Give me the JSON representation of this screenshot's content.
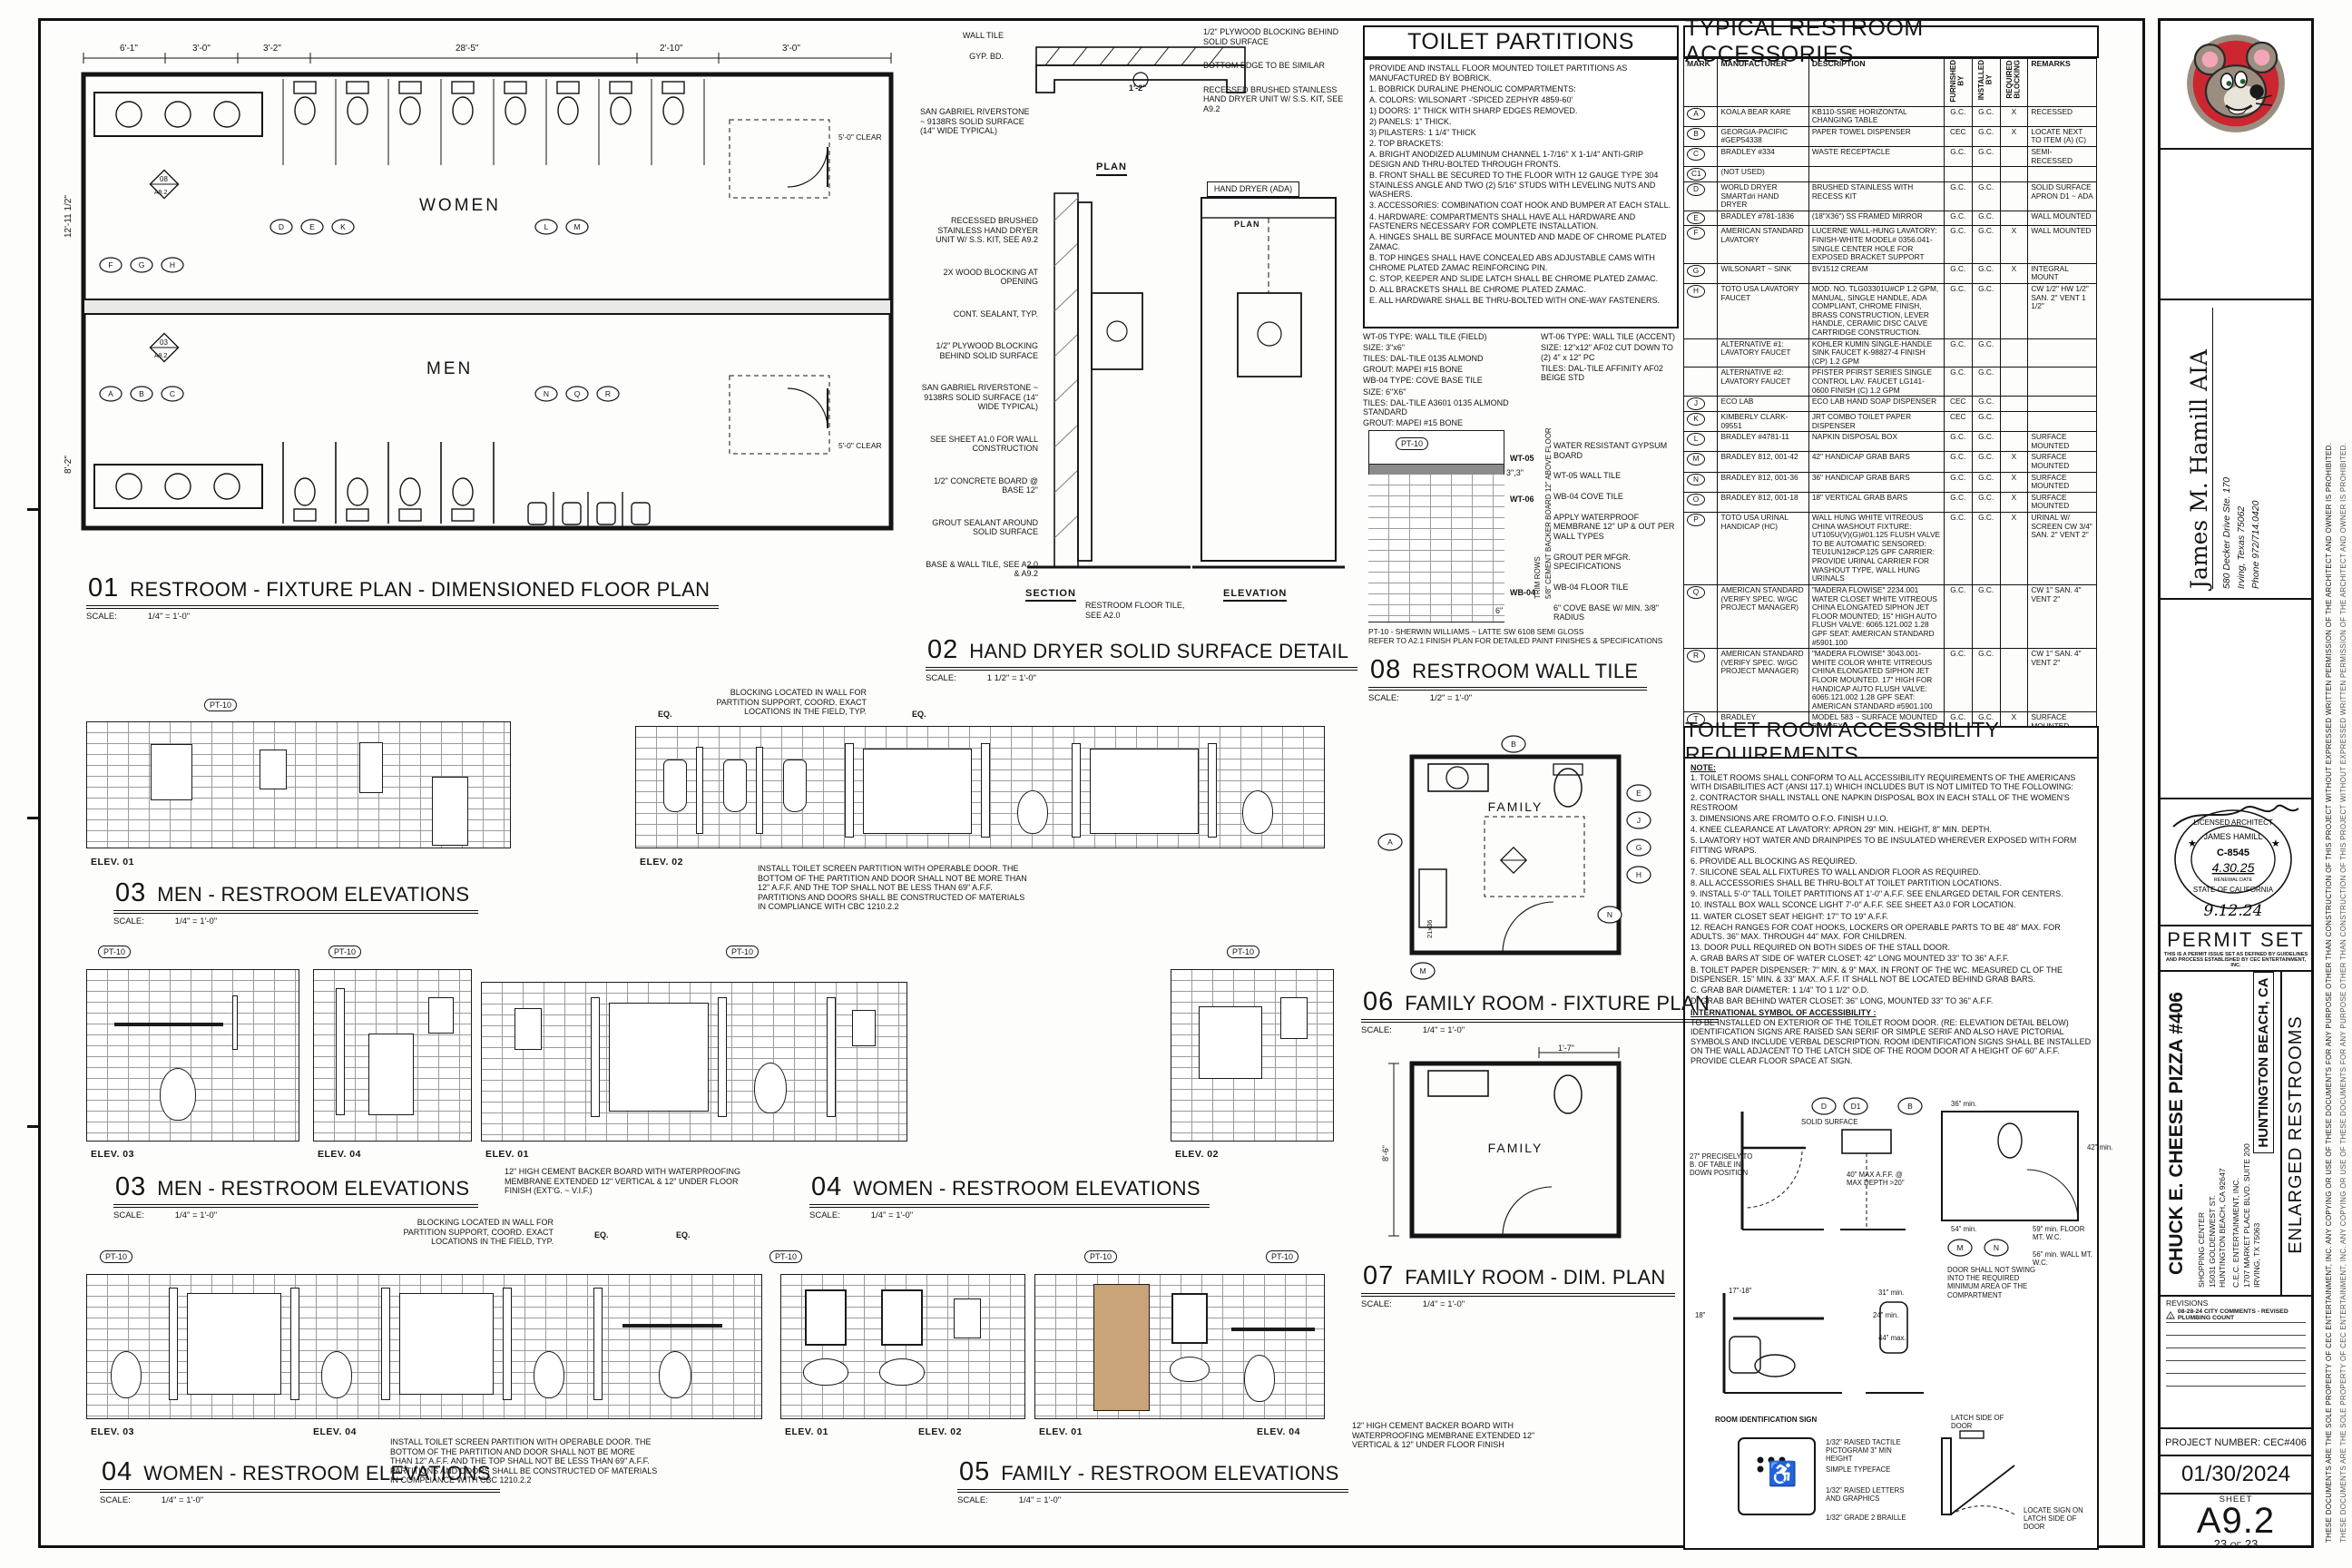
{
  "colors": {
    "logo_red": "#cc2630",
    "logo_taupe": "#9b8d80",
    "door_tan": "#c9a478",
    "accent_band": "#8b8b8b"
  },
  "labels": {
    "scale": "SCALE:",
    "plan": "PLAN",
    "section": "SECTION",
    "elevation": "ELEVATION",
    "women": "WOMEN",
    "men": "MEN",
    "family": "FAMILY",
    "eq": "EQ.",
    "pt10": "PT-10",
    "trash": "TRASH",
    "elev01": "ELEV. 01",
    "elev02": "ELEV. 02",
    "elev03": "ELEV. 03",
    "elev04": "ELEV. 04",
    "sheetref": "A7.5",
    "t1": "01",
    "t2": "02",
    "t3": "03",
    "t4": "04"
  },
  "panels": {
    "d01": {
      "num": "01",
      "title": "RESTROOM - FIXTURE PLAN - DIMENSIONED FLOOR PLAN",
      "scale": "1/4\" = 1'-0\""
    },
    "d02": {
      "num": "02",
      "title": "HAND DRYER SOLID SURFACE DETAIL",
      "scale": "1 1/2\" = 1'-0\""
    },
    "d03": {
      "num": "03",
      "title": "MEN - RESTROOM ELEVATIONS",
      "scale": "1/4\" = 1'-0\""
    },
    "d04": {
      "num": "04",
      "title": "WOMEN - RESTROOM ELEVATIONS",
      "scale": "1/4\" = 1'-0\""
    },
    "d05": {
      "num": "05",
      "title": "FAMILY - RESTROOM ELEVATIONS",
      "scale": "1/4\" = 1'-0\""
    },
    "d06": {
      "num": "06",
      "title": "FAMILY ROOM - FIXTURE PLAN",
      "scale": "1/4\" = 1'-0\""
    },
    "d07": {
      "num": "07",
      "title": "FAMILY ROOM - DIM. PLAN",
      "scale": "1/4\" = 1'-0\""
    },
    "d08": {
      "num": "08",
      "title": "RESTROOM WALL TILE",
      "scale": "1/2\" = 1'-0\""
    }
  },
  "partitions": {
    "title": "TOILET PARTITIONS",
    "lines": [
      "PROVIDE AND INSTALL FLOOR MOUNTED TOILET PARTITIONS AS MANUFACTURED BY BOBRICK.",
      "1. BOBRICK DURALINE PHENOLIC COMPARTMENTS:",
      "A. COLORS:  WILSONART -'SPICED ZEPHYR 4859-60'",
      "1) DOORS: 1\" THICK WITH SHARP EDGES REMOVED.",
      "2) PANELS:  1\" THICK.",
      "3)  PILASTERS:  1 1/4\" THICK",
      "2. TOP BRACKETS:",
      "A. BRIGHT ANODIZED ALUMINUM CHANNEL 1-7/16\" X 1-1/4\" ANTI-GRIP DESIGN AND THRU-BOLTED THROUGH FRONTS.",
      "B. FRONT SHALL BE SECURED TO THE FLOOR WITH 12 GAUGE TYPE 304 STAINLESS ANGLE AND TWO (2) 5/16\" STUDS WITH LEVELING NUTS AND WASHERS.",
      "3. ACCESSORIES:  COMBINATION COAT HOOK AND BUMPER AT EACH STALL.",
      "4. HARDWARE: COMPARTMENTS SHALL HAVE ALL HARDWARE AND FASTENERS NECESSARY FOR COMPLETE INSTALLATION.",
      "A. HINGES SHALL BE SURFACE MOUNTED AND MADE OF CHROME PLATED ZAMAC.",
      "B. TOP HINGES SHALL HAVE CONCEALED ABS ADJUSTABLE CAMS WITH CHROME PLATED ZAMAC REINFORCING PIN.",
      "C. STOP, KEEPER AND SLIDE LATCH SHALL BE CHROME PLATED ZAMAC.",
      "D. ALL BRACKETS SHALL BE CHROME PLATED ZAMAC.",
      "E.  ALL HARDWARE SHALL BE THRU-BOLTED WITH ONE-WAY FASTENERS."
    ]
  },
  "tile": {
    "wt05": [
      "WT-05 TYPE: WALL TILE (FIELD)",
      "SIZE:  3\"x6\"",
      "TILES: DAL-TILE 0135 ALMOND",
      "GROUT:      MAPEI #15 BONE",
      "WB-04 TYPE: COVE BASE TILE",
      "SIZE:  6\"X6\"",
      "TILES: DAL-TILE A3601 0135 ALMOND STANDARD",
      "GROUT:      MAPEI #15 BONE"
    ],
    "wt06": [
      "WT-06 TYPE: WALL TILE (ACCENT)",
      "SIZE:  12\"x12\" AF02 CUT DOWN TO (2) 4\" x 12\" PC",
      "TILES: DAL-TILE  AFFINITY AF02 BEIGE STD"
    ],
    "tag05": "WT-05",
    "tag06": "WT-06",
    "tag04": "WB-04",
    "callouts_right": [
      "WATER RESISTANT GYPSUM BOARD",
      "WT-05 WALL TILE",
      "WB-04 COVE TILE",
      "APPLY WATERPROOF MEMBRANE 12\" UP & OUT PER WALL TYPES",
      "GROUT PER MFGR. SPECIFICATIONS",
      "WB-04 FLOOR TILE",
      "6\" COVE BASE W/ MIN. 3/8\" RADIUS"
    ],
    "vert1": "5/8\" CEMENT BACKER BOARD 12\" ABOVE FLOOR",
    "vert2": "TRIM ROWS",
    "dim33": "3\",3\"",
    "dim6": "6\"",
    "note1": "PT-10 - SHERWIN WILLIAMS ~ LATTE SW 6108 SEMI GLOSS",
    "note2": "REFER TO A2.1 FINISH PLAN FOR DETAILED PAINT FINISHES & SPECIFICATIONS"
  },
  "accessories": {
    "title": "TYPICAL RESTROOM ACCESSORIES",
    "h_mark": "MARK",
    "h_mfr": "MANUFACTURER",
    "h_desc": "DESCRIPTION",
    "h_furn": "FURNISHED\nBY",
    "h_inst": "INSTALLED\nBY",
    "h_blk": "REQUIRED\nBLOCKING",
    "h_rem": "REMARKS",
    "rows": [
      {
        "m": "A",
        "mfr": "KOALA BEAR KARE",
        "d": "KB110-SSRE HORIZONTAL CHANGING TABLE",
        "f": "G.C.",
        "i": "G.C.",
        "b": "X",
        "r": "RECESSED"
      },
      {
        "m": "B",
        "mfr": "GEORGIA-PACIFIC #GEP54338",
        "d": "PAPER TOWEL DISPENSER",
        "f": "CEC",
        "i": "G.C.",
        "b": "X",
        "r": "LOCATE NEXT TO ITEM (A) (C)"
      },
      {
        "m": "C",
        "mfr": "BRADLEY #334",
        "d": "WASTE RECEPTACLE",
        "f": "G.C.",
        "i": "G.C.",
        "b": "",
        "r": "SEMI-RECESSED"
      },
      {
        "m": "C1",
        "mfr": "(NOT USED)",
        "d": "",
        "f": "",
        "i": "",
        "b": "",
        "r": ""
      },
      {
        "m": "D",
        "mfr": "WORLD DRYER SMARTdri HAND DRYER",
        "d": "BRUSHED STAINLESS WITH RECESS KIT",
        "f": "G.C.",
        "i": "G.C.",
        "b": "",
        "r": "SOLID SURFACE APRON D1 ~ ADA"
      },
      {
        "m": "E",
        "mfr": "BRADLEY #781-1836",
        "d": "(18\"X36\") SS FRAMED MIRROR",
        "f": "G.C.",
        "i": "G.C.",
        "b": "",
        "r": "WALL MOUNTED"
      },
      {
        "m": "F",
        "mfr": "AMERICAN STANDARD LAVATORY",
        "d": "LUCERNE WALL-HUNG LAVATORY: FINISH-WHITE MODEL# 0356.041-SINGLE CENTER HOLE FOR EXPOSED BRACKET SUPPORT",
        "f": "G.C.",
        "i": "G.C.",
        "b": "X",
        "r": "WALL MOUNTED"
      },
      {
        "m": "G",
        "mfr": "WILSONART ~ SINK",
        "d": "BV1512 CREAM",
        "f": "G.C.",
        "i": "G.C.",
        "b": "X",
        "r": "INTEGRAL MOUNT"
      },
      {
        "m": "H",
        "mfr": "TOTO USA LAVATORY FAUCET",
        "d": "MOD. NO. TLG03301U#CP 1.2 GPM, MANUAL, SINGLE HANDLE, ADA COMPLIANT, CHROME FINISH, BRASS CONSTRUCTION, LEVER HANDLE, CERAMIC DISC CALVE CARTRIDGE CONSTRUCTION.",
        "f": "G.C.",
        "i": "G.C.",
        "b": "",
        "r": "CW 1/2\"  HW 1/2\"  SAN. 2\"  VENT 1 1/2\""
      },
      {
        "m": "",
        "mfr": "ALTERNATIVE #1: LAVATORY FAUCET",
        "d": "KOHLER KUMIN SINGLE-HANDLE SINK FAUCET K-98827-4 FINISH (CP)  1.2 GPM",
        "f": "G.C.",
        "i": "G.C.",
        "b": "",
        "r": ""
      },
      {
        "m": "",
        "mfr": "ALTERNATIVE #2: LAVATORY FAUCET",
        "d": "PFISTER PFIRST SERIES SINGLE CONTROL LAV. FAUCET LG141-0600 FINISH (C)  1.2 GPM",
        "f": "G.C.",
        "i": "G.C.",
        "b": "",
        "r": ""
      },
      {
        "m": "J",
        "mfr": "ECO LAB",
        "d": "ECO LAB HAND SOAP DISPENSER",
        "f": "CEC",
        "i": "G.C.",
        "b": "",
        "r": ""
      },
      {
        "m": "K",
        "mfr": "KIMBERLY CLARK-09551",
        "d": "JRT COMBO TOILET PAPER DISPENSER",
        "f": "CEC",
        "i": "G.C.",
        "b": "",
        "r": ""
      },
      {
        "m": "L",
        "mfr": "BRADLEY #4781-11",
        "d": "NAPKIN DISPOSAL BOX",
        "f": "G.C.",
        "i": "G.C.",
        "b": "",
        "r": "SURFACE MOUNTED"
      },
      {
        "m": "M",
        "mfr": "BRADLEY 812, 001-42",
        "d": "42\" HANDICAP GRAB BARS",
        "f": "G.C.",
        "i": "G.C.",
        "b": "X",
        "r": "SURFACE MOUNTED"
      },
      {
        "m": "N",
        "mfr": "BRADLEY 812, 001-36",
        "d": "36\" HANDICAP GRAB BARS",
        "f": "G.C.",
        "i": "G.C.",
        "b": "X",
        "r": "SURFACE MOUNTED"
      },
      {
        "m": "O",
        "mfr": "BRADLEY 812, 001-18",
        "d": "18\" VERTICAL GRAB BARS",
        "f": "G.C.",
        "i": "G.C.",
        "b": "X",
        "r": "SURFACE MOUNTED"
      },
      {
        "m": "P",
        "mfr": "TOTO USA URINAL HANDICAP (HC)",
        "d": "WALL HUNG WHITE VITREOUS CHINA WASHOUT FIXTURE: UT105U(V)(G)#01.125  FLUSH VALVE TO BE AUTOMATIC SENSORED: TEU1UN12#CP.125 GPF  CARRIER: PROVIDE URINAL CARRIER FOR WASHOUT TYPE, WALL HUNG URINALS",
        "f": "G.C.",
        "i": "G.C.",
        "b": "X",
        "r": "URINAL W/ SCREEN   CW 3/4\"  SAN. 2\"  VENT 2\""
      },
      {
        "m": "Q",
        "mfr": "AMERICAN STANDARD (VERIFY SPEC. W/GC PROJECT MANAGER)",
        "d": "\"MADERA FLOWISE\" 2234.001 WATER CLOSET WHITE VITREOUS CHINA ELONGATED SIPHON JET FLOOR MOUNTED; 15\" HIGH   AUTO FLUSH VALVE: 6065.121.002  1.28 GPF   SEAT: AMERICAN STANDARD #5901.100",
        "f": "G.C.",
        "i": "G.C.",
        "b": "",
        "r": "CW 1\"  SAN. 4\"  VENT 2\""
      },
      {
        "m": "R",
        "mfr": "AMERICAN STANDARD (VERIFY SPEC. W/GC PROJECT MANAGER)",
        "d": "\"MADERA FLOWISE\" 3043.001-WHITE COLOR WHITE VITREOUS CHINA ELONGATED SIPHON JET FLOOR MOUNTED. 17\" HIGH FOR HANDICAP   AUTO FLUSH VALVE: 6065.121.002  1.28 GPF   SEAT: AMERICAN STANDARD #5901.100",
        "f": "G.C.",
        "i": "G.C.",
        "b": "",
        "r": "CW 1\"  SAN. 4\"  VENT 2\""
      },
      {
        "m": "T",
        "mfr": "BRADLEY",
        "d": "MODEL 583 ~ SURFACE MOUNTED BRADEX",
        "f": "G.C.",
        "i": "G.C.",
        "b": "X",
        "r": "SURFACE MOUNTED"
      },
      {
        "m": "SS-04",
        "mfr": "WILSONART COUNTER",
        "d": "SAN GABRIEL RIVERSTONE 9138RS SOLID SURFACE",
        "f": "G.C.",
        "i": "G.C.",
        "b": "",
        "r": ""
      }
    ]
  },
  "access": {
    "title": "TOILET ROOM ACCESSIBILITY REQUIREMENTS",
    "note_label": "NOTE:",
    "notes": [
      "1. TOILET ROOMS SHALL CONFORM TO ALL ACCESSIBILITY REQUIREMENTS OF THE AMERICANS WITH DISABILITIES ACT (ANSI 117.1) WHICH  INCLUDES BUT IS NOT LIMITED TO THE FOLLOWING:",
      "2. CONTRACTOR SHALL INSTALL ONE NAPKIN DISPOSAL BOX IN EACH STALL OF THE WOMEN'S RESTROOM",
      "3. DIMENSIONS ARE FROM/TO O.F.O. FINISH U.I.O.",
      "4. KNEE CLEARANCE AT LAVATORY: APRON 29\" MIN. HEIGHT, 8\" MIN. DEPTH.",
      "5. LAVATORY HOT WATER AND DRAINPIPES TO BE INSULATED WHEREVER EXPOSED WITH FORM FITTING WRAPS.",
      "6. PROVIDE ALL BLOCKING AS REQUIRED.",
      "7. SILICONE SEAL ALL FIXTURES TO WALL AND/OR FLOOR AS REQUIRED.",
      "8. ALL ACCESSORIES SHALL BE THRU-BOLT AT TOILET PARTITION LOCATIONS.",
      "9. INSTALL 5'-0\" TALL TOILET PARTITIONS AT 1'-0\" A.F.F. SEE ENLARGED DETAIL FOR CENTERS.",
      "10. INSTALL BOX WALL SCONCE LIGHT 7'-0\" A.F.F. SEE SHEET A3.0 FOR LOCATION.",
      "11. WATER CLOSET SEAT HEIGHT: 17\" TO 19\" A.F.F.",
      "12. REACH RANGES FOR COAT HOOKS, LOCKERS OR OPERABLE PARTS TO BE 48\" MAX. FOR ADULTS. 36\" MAX. THROUGH 44\" MAX. FOR CHILDREN.",
      "13. DOOR PULL REQUIRED ON BOTH SIDES OF THE STALL DOOR.",
      "A. GRAB BARS AT SIDE OF WATER CLOSET: 42\" LONG MOUNTED 33\" TO 36\" A.F.F.",
      "B. TOILET PAPER DISPENSER: 7\" MIN. & 9\" MAX. IN FRONT OF THE WC. MEASURED CL OF THE DISPENSER. 15\" MIN. & 33\" MAX. A.F.F. IT SHALL NOT BE LOCATED BEHIND GRAB BARS.",
      "C. GRAB BAR DIAMETER: 1 1/4\" TO 1 1/2\" O.D.",
      "D. GRAB BAR BEHIND WATER CLOSET: 36\" LONG, MOUNTED 33\" TO 36\" A.F.F."
    ],
    "isa_heading": "INTERNATIONAL SYMBOL OF ACCESSIBILITY :",
    "isa_text": "TO BE INSTALLED ON EXTERIOR OF THE TOILET ROOM DOOR. (RE: ELEVATION DETAIL BELOW) IDENTIFICATION SIGNS ARE RAISED SAN SERIF OR SIMPLE SERIF AND ALSO HAVE PICTORIAL SYMBOLS AND INCLUDE VERBAL DESCRIPTION. ROOM IDENTIFICATION SIGNS SHALL BE INSTALLED ON THE WALL ADJACENT TO THE LATCH SIDE OF THE ROOM DOOR AT A HEIGHT OF 60\" A.F.F. PROVIDE CLEAR FLOOR SPACE AT SIGN.",
    "diagram": {
      "d27": "27\" PRECISELY TO B. OF TABLE IN DOWN POSITION",
      "solid_surface": "SOLID SURFACE",
      "d40": "40\" MAX A.F.F. @ MAX DEPTH >20\"",
      "d31": "31\" min.",
      "d44": "44\" max.",
      "d36": "36\" min.",
      "d42": "42\" min.",
      "d54": "54\" min.",
      "d24": "24\" min.",
      "d18": "18\"",
      "d1718": "17\"-18\"",
      "d79": "7\"-9\"",
      "d6": "6\" max.",
      "d59": "59\" min. FLOOR MT. W.C.",
      "d56": "56\" min. WALL MT. W.C.",
      "door_note": "DOOR SHALL NOT SWING INTO THE REQUIRED MINIMUM AREA OF THE COMPARTMENT",
      "sign_title": "ROOM IDENTIFICATION SIGN",
      "sign1": "1/32\" RAISED TACTILE PICTOGRAM 3\" MIN HEIGHT",
      "sign2": "SIMPLE TYPEFACE",
      "sign3": "1/32\" RAISED LETTERS AND GRAPHICS",
      "sign4": "1/32\" GRADE 2  BRAILLE",
      "latch1": "LATCH SIDE OF DOOR",
      "latch2": "LOCATE SIGN ON LATCH SIDE OF DOOR",
      "b1": "D",
      "b2": "D1",
      "b3": "B",
      "b4": "J",
      "b5": "M",
      "b6": "N",
      "b7": "R"
    }
  },
  "detail02": {
    "plan_left": [
      "WALL TILE",
      "GYP. BD."
    ],
    "plan_right": [
      "1/2\" PLYWOOD BLOCKING BEHIND SOLID SURFACE",
      "BOTTOM EDGE TO BE SIMILAR",
      "RECESSED BRUSHED STAINLESS HAND DRYER UNIT W/ S.S. KIT, SEE A9.2"
    ],
    "plan_dim": "1'-2\"",
    "sg": "SAN GABRIEL RIVERSTONE ~ 9138RS SOLID SURFACE (14\" WIDE TYPICAL)",
    "section_callouts": [
      "RECESSED BRUSHED STAINLESS HAND DRYER UNIT W/ S.S. KIT, SEE A9.2",
      "2X WOOD BLOCKING AT OPENING",
      "CONT. SEALANT, TYP.",
      "1/2\" PLYWOOD BLOCKING BEHIND SOLID SURFACE",
      "SAN GABRIEL RIVERSTONE ~ 9138RS SOLID SURFACE (14\" WIDE TYPICAL)",
      "SEE  SHEET A1.0 FOR WALL CONSTRUCTION",
      "1/2\" CONCRETE BOARD @ BASE 12\"",
      "GROUT SEALANT AROUND SOLID SURFACE",
      "BASE & WALL TILE, SEE A2.0 & A9.2"
    ],
    "hand_dryer_ada": "HAND DRYER (ADA)",
    "floor_tile": "RESTROOM FLOOR TILE, SEE A2.0"
  },
  "plan01": {
    "women": "WOMEN",
    "men": "MEN",
    "dims": [
      "6'-1\"",
      "3'-0\"",
      "3'-2\"",
      "28'-5\"",
      "2'-10\"",
      "3'-0\"",
      "12'-11 1/2\"",
      "8'-2\"",
      "2'-8\"",
      "3 5/8\"",
      "2'-2\"",
      "5'-0\" CLEAR"
    ],
    "clear": "CLEAR",
    "bubbles": [
      "A",
      "B",
      "C",
      "D",
      "E",
      "F",
      "G",
      "H",
      "K",
      "L",
      "M",
      "N",
      "Q",
      "R"
    ],
    "dia_top1": "08",
    "dia_top2": "03",
    "dia_sheet": "A9.2"
  },
  "elevnotes": {
    "screen": "INSTALL TOILET SCREEN PARTITION WITH OPERABLE DOOR. THE BOTTOM OF THE PARTITION AND DOOR SHALL NOT BE MORE THAN 12\" A.F.F. AND THE TOP SHALL NOT BE LESS THAN 69\" A.F.F. PARTITIONS AND DOORS SHALL BE CONSTRUCTED OF MATERIALS IN COMPLIANCE WITH CBC 1210.2.2",
    "blocking": "BLOCKING LOCATED IN WALL FOR PARTITION SUPPORT, COORD. EXACT LOCATIONS IN THE FIELD, TYP.",
    "backer1": "12\" HIGH CEMENT BACKER BOARD WITH WATERPROOFING MEMBRANE EXTENDED 12\" VERTICAL & 12\" UNDER FLOOR FINISH (EXT'G. ~ V.I.F.)",
    "backer2": "12\" HIGH CEMENT BACKER BOARD WITH WATERPROOFING MEMBRANE EXTENDED 12\" VERTICAL & 12\" UNDER FLOOR FINISH"
  },
  "family": {
    "label": "FAMILY",
    "dim1": "8'-6\"",
    "dim2": "1'-7\"",
    "dim3": "5'-0\"",
    "table": "21x36",
    "bubbles": [
      "A",
      "B",
      "E",
      "J",
      "G",
      "H",
      "N",
      "M",
      "L",
      "K"
    ]
  },
  "titleblock": {
    "architect": {
      "name": "James M. Hamill AIA",
      "addr1": "580 Decker Drive Ste. 170",
      "addr2": "Irving, Texas  75062",
      "addr3": "Phone  972/714.0420"
    },
    "stamp": {
      "arc": "LICENSED ARCHITECT",
      "name": "JAMES HAMILL",
      "lic": "C-8545",
      "renewal": "4.30.25",
      "renewal_lbl": "RENEWAL DATE",
      "state": "STATE OF CALIFORNIA",
      "signed": "9.12.24"
    },
    "permit": {
      "title": "PERMIT SET",
      "sub1": "THIS IS A PERMIT ISSUE SET AS DEFINED BY GUIDELINES",
      "sub2": "AND  PROCESS  ESTABLISHED  BY  CEC   ENTERTAINMENT, INC."
    },
    "project": {
      "name": "CHUCK E. CHEESE PIZZA  #406",
      "center": "SHOPPING CENTER",
      "addr1": "15031 GOLDENWEST ST.",
      "addr2": "HUNTINGTON BEACH, CA 92647",
      "cec1": "C.E.C. ENTERTAINMENT, INC.",
      "cec2": "1707 MARKET PLACE BLVD. SUITE 200",
      "cec3": "IRVING, TX 75063",
      "city": "HUNTINGTON BEACH, CA",
      "sheet_name": "ENLARGED RESTROOMS"
    },
    "revisions": {
      "title": "REVISIONS",
      "r1_num": "1",
      "r1": "08-28-24 CITY COMMENTS - REVISED PLUMBING COUNT"
    },
    "proj_num": "PROJECT NUMBER: CEC#406",
    "date": "01/30/2024",
    "sheet": {
      "label": "SHEET",
      "num": "A9.2",
      "page": "23",
      "of": "OF",
      "total": "23"
    },
    "disclaimer": "THESE DOCUMENTS ARE THE SOLE PROPERTY OF CEC ENTERTAINMENT, INC. ANY COPYING OR USE OF THESE DOCUMENTS FOR ANY PURPOSE OTHER THAN CONSTRUCTION OF THIS PROJECT WITHOUT EXPRESSED WRITTEN PERMISSION OF THE ARCHITECT AND OWNER IS PROHIBITED."
  }
}
